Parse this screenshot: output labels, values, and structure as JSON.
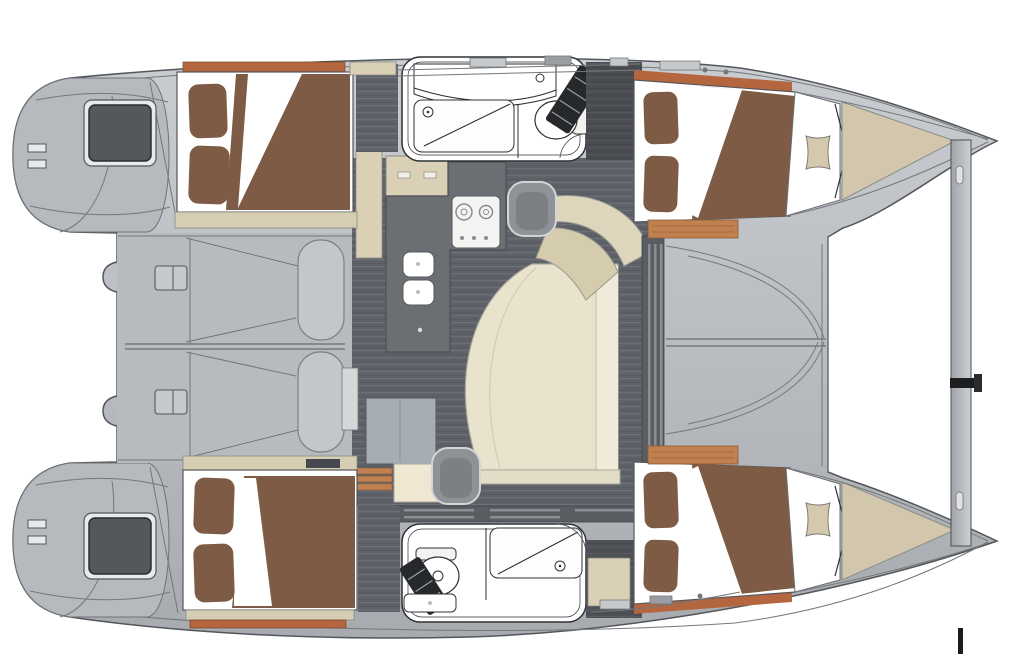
{
  "page": {
    "kind": "boat floor plan illustration",
    "view": "top-down catamaran interior layout, bows to the right",
    "canvas": {
      "width": 1016,
      "height": 665
    }
  },
  "palette": {
    "background": "#ffffff",
    "hull_deck_light": "#c9ccd0",
    "hull_deck": "#b9bcc0",
    "hull_deck_dark": "#a7abaf",
    "cockpit_deck": "#b7babe",
    "hull_outline": "#53565a",
    "panel_line": "#74777b",
    "bed_brown": "#7d5b45",
    "linen_white": "#ffffff",
    "wood_trim_orange": "#c08050",
    "headboard_orange": "#b4673f",
    "shelf_beige": "#d6cdb2",
    "cabinet_beige": "#d9d0b6",
    "bow_wedge_beige": "#d2c7ad",
    "cushion_beige": "#d4c9ad",
    "sofa_cream": "#e9e2cd",
    "sofa_back_cream": "#f0ead8",
    "sofa_plinth": "#e3dcc6",
    "desk_beige": "#ded6bc",
    "desk_seat_beige": "#d5ccae",
    "floor_base": "#5e6268",
    "floor_stripe": "#6d7177",
    "counter_gray": "#6b6f74",
    "fridge_gray": "#a6adb5",
    "cream_cabinet": "#efe7d2",
    "wall_dark": "#5a5e63",
    "window_dark": "#54585c",
    "window_frame": "#e8e9ea",
    "fixture_line": "#2e3134",
    "stairs_dark": "#26282b",
    "beam_light": "#ced1d4",
    "beam_dark": "#9fa3a7",
    "slat_light": "#d4d6d8",
    "chair_gray": "#8f9398",
    "chair_seat_gray": "#7c8085"
  },
  "plan": {
    "hull_top": {
      "stern": "transom with steps and dark deck hatch",
      "aft_cabin": "double berth, brown duvet, two pillows",
      "head": "wet head: vanity, shower pan, toilet, companionway stairs",
      "forward_cabin": "double berth with orange headboard",
      "bow": "forepeak with square cushion and beige wedge locker"
    },
    "hull_bottom": {
      "stern": "transom with steps and dark deck hatch",
      "aft_cabin": "double berth, brown duvet, two pillows",
      "head": "wet head: toilet, shower pan, sink, companionway stairs",
      "forward_cabin": "double berth with orange headboard",
      "bow": "forepeak with square cushion and beige wedge locker"
    },
    "bridgedeck": {
      "cockpit": "twin molded bench seats with deck latches",
      "salon": "L-shaped galley counter, two-burner cooktop, twin sinks, fridge cabinet, curved cream sofa, chart desk with seat",
      "foredeck": "molded deck between bows",
      "crossbeam": "forward crossbeam between bow tips"
    }
  }
}
